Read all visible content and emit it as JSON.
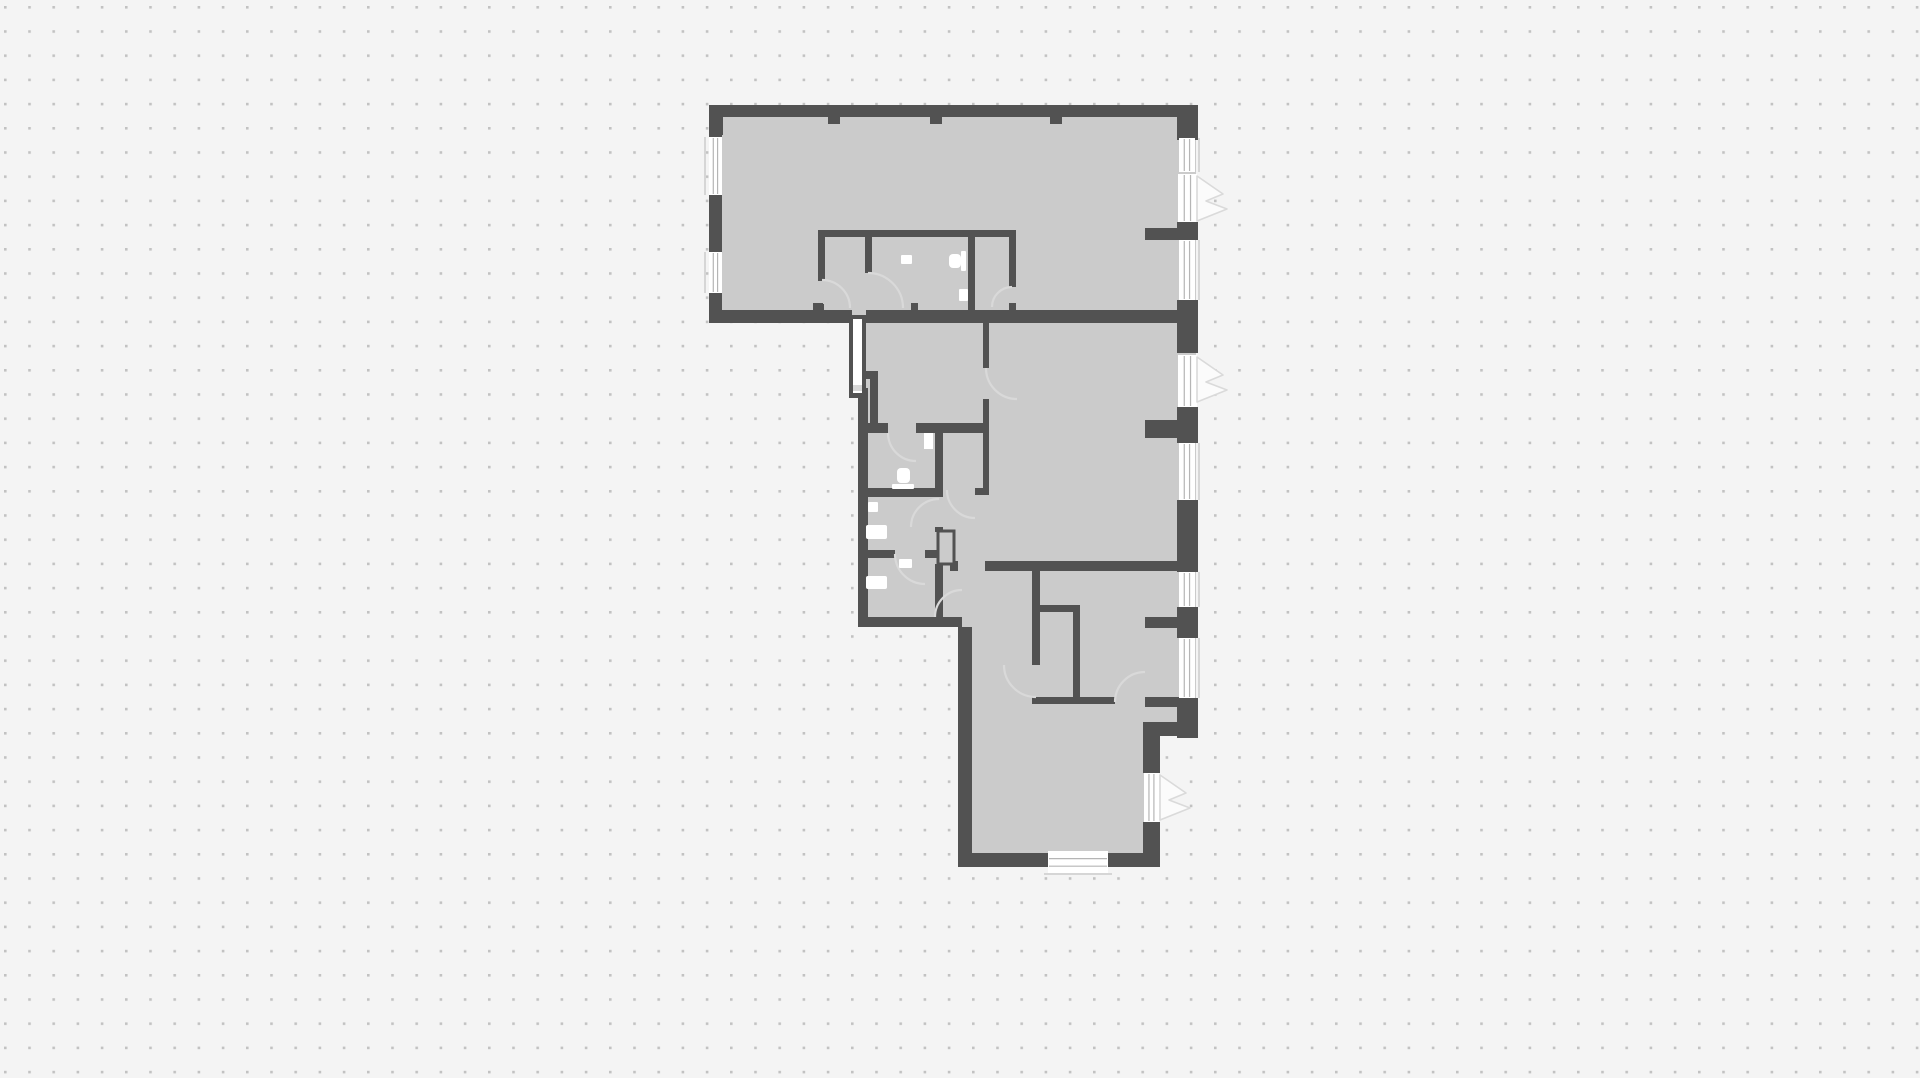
{
  "meta": {
    "width": 1920,
    "height": 1078,
    "dot_spacing": 24.2,
    "dot_size": 2.6,
    "dot_offset_x": 4,
    "dot_offset_y": 6
  },
  "styles": {
    "background": "#f4f4f4",
    "dot": "#c2c2c2",
    "floor": "#cbcbcb",
    "wall": "#525252",
    "opening": "#ffffff",
    "swing_line": "#d9d9d9",
    "wedge_fill": "#fbfbfb",
    "wedge_line": "#dadada",
    "window_line": "#b5b5b5",
    "sill": "#d6d6d6",
    "notch": "#d8d8d8",
    "fixture": "#ffffff"
  },
  "plan": {
    "floor_path": "M 710,106 L 1196,106 L 1196,734 L 1158,734 L 1158,866 L 958,866 L 958,626 L 861,626 L 861,398 L 850,398 L 850,316 L 710,316 Z",
    "walls": [
      {
        "name": "top-wall",
        "x": 709,
        "y": 105,
        "w": 489,
        "h": 12
      },
      {
        "name": "top-left-corner",
        "x": 709,
        "y": 105,
        "w": 14,
        "h": 30
      },
      {
        "name": "left-wall-a",
        "x": 709,
        "y": 117,
        "w": 13,
        "h": 20
      },
      {
        "name": "left-wall-b",
        "x": 709,
        "y": 195,
        "w": 13,
        "h": 57
      },
      {
        "name": "left-wall-c",
        "x": 709,
        "y": 293,
        "w": 13,
        "h": 30
      },
      {
        "name": "top-block-bottom-wall-left",
        "x": 709,
        "y": 310,
        "w": 143,
        "h": 13
      },
      {
        "name": "top-block-bottom-wall-right",
        "x": 866,
        "y": 310,
        "w": 332,
        "h": 13
      },
      {
        "name": "right-pier-1",
        "x": 1177,
        "y": 105,
        "w": 21,
        "h": 35
      },
      {
        "name": "right-pier-2",
        "x": 1177,
        "y": 222,
        "w": 21,
        "h": 18
      },
      {
        "name": "right-pier-3",
        "x": 1177,
        "y": 300,
        "w": 21,
        "h": 53
      },
      {
        "name": "right-pier-4",
        "x": 1177,
        "y": 407,
        "w": 21,
        "h": 36
      },
      {
        "name": "right-pier-5",
        "x": 1177,
        "y": 500,
        "w": 21,
        "h": 72
      },
      {
        "name": "right-pier-6",
        "x": 1177,
        "y": 607,
        "w": 21,
        "h": 31
      },
      {
        "name": "right-pier-7",
        "x": 1177,
        "y": 698,
        "w": 21,
        "h": 40
      },
      {
        "name": "left-wall-middle",
        "x": 858,
        "y": 388,
        "w": 10,
        "h": 239
      },
      {
        "name": "wing-bottom-wall",
        "x": 858,
        "y": 617,
        "w": 104,
        "h": 10
      },
      {
        "name": "bottom-room-left-wall",
        "x": 958,
        "y": 627,
        "w": 14,
        "h": 240
      },
      {
        "name": "bottom-wall-left",
        "x": 958,
        "y": 853,
        "w": 90,
        "h": 14
      },
      {
        "name": "bottom-wall-right",
        "x": 1108,
        "y": 853,
        "w": 52,
        "h": 14
      },
      {
        "name": "step-wall-h",
        "x": 1143,
        "y": 722,
        "w": 55,
        "h": 14
      },
      {
        "name": "lower-right-wall-a",
        "x": 1143,
        "y": 736,
        "w": 17,
        "h": 37
      },
      {
        "name": "lower-right-wall-b",
        "x": 1143,
        "y": 822,
        "w": 17,
        "h": 45
      },
      {
        "name": "stub-top-room",
        "x": 1145,
        "y": 228,
        "w": 32,
        "h": 12
      },
      {
        "name": "stub-middle-room",
        "x": 1145,
        "y": 420,
        "w": 32,
        "h": 18
      },
      {
        "name": "stub-bedroom",
        "x": 1145,
        "y": 617,
        "w": 32,
        "h": 11
      },
      {
        "name": "stub-step",
        "x": 1145,
        "y": 697,
        "w": 35,
        "h": 10
      },
      {
        "name": "mid-bottom-wall",
        "x": 985,
        "y": 561,
        "w": 213,
        "h": 10
      },
      {
        "name": "mid-bottom-wall-left",
        "x": 950,
        "y": 561,
        "w": 8,
        "h": 10
      },
      {
        "name": "partition-h1",
        "x": 818,
        "y": 230,
        "w": 198,
        "h": 7
      },
      {
        "name": "partition-va",
        "x": 818,
        "y": 237,
        "w": 7,
        "h": 44
      },
      {
        "name": "partition-va-foot",
        "x": 817,
        "y": 304,
        "w": 7,
        "h": 7
      },
      {
        "name": "partition-vb",
        "x": 865,
        "y": 237,
        "w": 7,
        "h": 36
      },
      {
        "name": "partition-vc",
        "x": 968,
        "y": 237,
        "w": 7,
        "h": 76
      },
      {
        "name": "partition-vd",
        "x": 1009,
        "y": 237,
        "w": 7,
        "h": 50
      },
      {
        "name": "partition-vd-foot",
        "x": 1009,
        "y": 303,
        "w": 7,
        "h": 10
      },
      {
        "name": "nook-h",
        "x": 866,
        "y": 371,
        "w": 12,
        "h": 8
      },
      {
        "name": "nook-v",
        "x": 870,
        "y": 379,
        "w": 8,
        "h": 49
      },
      {
        "name": "entry-bottom-wall-a",
        "x": 866,
        "y": 423,
        "w": 22,
        "h": 10
      },
      {
        "name": "entry-bottom-wall-b",
        "x": 916,
        "y": 423,
        "w": 67,
        "h": 10
      },
      {
        "name": "hall-wall-top",
        "x": 983,
        "y": 322,
        "w": 6,
        "h": 46
      },
      {
        "name": "hall-wall-mid",
        "x": 983,
        "y": 399,
        "w": 6,
        "h": 89
      },
      {
        "name": "hall-wall-foot",
        "x": 975,
        "y": 488,
        "w": 14,
        "h": 7
      },
      {
        "name": "corridor-wall",
        "x": 935,
        "y": 423,
        "w": 8,
        "h": 74
      },
      {
        "name": "corridor-wall-foot",
        "x": 935,
        "y": 527,
        "w": 8,
        "h": 5
      },
      {
        "name": "bath1-bottom-wall",
        "x": 866,
        "y": 488,
        "w": 71,
        "h": 9
      },
      {
        "name": "bath2-bottom-wall-a",
        "x": 866,
        "y": 550,
        "w": 29,
        "h": 8
      },
      {
        "name": "bath2-bottom-wall-b",
        "x": 925,
        "y": 550,
        "w": 13,
        "h": 8
      },
      {
        "name": "vestibule-wall",
        "x": 935,
        "y": 564,
        "w": 8,
        "h": 53
      },
      {
        "name": "bottom-block-wall-v1",
        "x": 1032,
        "y": 571,
        "w": 8,
        "h": 94
      },
      {
        "name": "closet-wall-h",
        "x": 1036,
        "y": 605,
        "w": 44,
        "h": 7
      },
      {
        "name": "closet-wall-v",
        "x": 1073,
        "y": 612,
        "w": 7,
        "h": 86
      },
      {
        "name": "bottom-room-wall-h",
        "x": 1032,
        "y": 697,
        "w": 83,
        "h": 7
      },
      {
        "name": "tick-top-1",
        "x": 828,
        "y": 117,
        "w": 12,
        "h": 7
      },
      {
        "name": "tick-top-2",
        "x": 930,
        "y": 117,
        "w": 12,
        "h": 7
      },
      {
        "name": "tick-top-3",
        "x": 1050,
        "y": 117,
        "w": 12,
        "h": 7
      },
      {
        "name": "tick-bottom-1",
        "x": 813,
        "y": 303,
        "w": 10,
        "h": 7
      },
      {
        "name": "tick-bottom-2",
        "x": 911,
        "y": 303,
        "w": 7,
        "h": 7
      },
      {
        "name": "tick-wing",
        "x": 935,
        "y": 610,
        "w": 8,
        "h": 7
      }
    ],
    "shaft": {
      "outer": {
        "name": "shaft-outer",
        "x": 849,
        "y": 315,
        "w": 17,
        "h": 83
      },
      "inner": {
        "name": "shaft-inner",
        "x": 853,
        "y": 319,
        "w": 9,
        "h": 74
      },
      "notch": {
        "name": "shaft-notch",
        "x": 853,
        "y": 385,
        "w": 9,
        "h": 6
      }
    },
    "duct": {
      "name": "duct-box",
      "x": 938,
      "y": 531,
      "w": 16,
      "h": 33
    },
    "windows": [
      {
        "name": "window-left-1",
        "x": 709,
        "y": 137,
        "w": 13,
        "h": 58,
        "axis": "v",
        "sill": "left"
      },
      {
        "name": "window-left-2",
        "x": 709,
        "y": 252,
        "w": 13,
        "h": 41,
        "axis": "v",
        "sill": "left"
      },
      {
        "name": "window-right-1",
        "x": 1179,
        "y": 138,
        "w": 16,
        "h": 34,
        "axis": "v",
        "sill": "right"
      },
      {
        "name": "window-right-2",
        "x": 1179,
        "y": 240,
        "w": 16,
        "h": 60,
        "axis": "v",
        "sill": "right"
      },
      {
        "name": "window-right-3",
        "x": 1179,
        "y": 443,
        "w": 16,
        "h": 57,
        "axis": "v",
        "sill": "right"
      },
      {
        "name": "window-right-4",
        "x": 1179,
        "y": 572,
        "w": 16,
        "h": 35,
        "axis": "v",
        "sill": "right"
      },
      {
        "name": "window-right-5",
        "x": 1179,
        "y": 638,
        "w": 16,
        "h": 60,
        "axis": "v",
        "sill": "right"
      },
      {
        "name": "window-bottom-1",
        "x": 1048,
        "y": 851,
        "w": 60,
        "h": 23,
        "axis": "h",
        "sill": "bottom"
      },
      {
        "name": "balcony-door-opening-top",
        "x": 1178,
        "y": 174,
        "w": 19,
        "h": 48,
        "axis": "v"
      },
      {
        "name": "balcony-door-opening-middle",
        "x": 1178,
        "y": 355,
        "w": 19,
        "h": 52,
        "axis": "v"
      },
      {
        "name": "balcony-door-opening-bottom",
        "x": 1144,
        "y": 773,
        "w": 15,
        "h": 49,
        "axis": "v"
      }
    ],
    "door_wedges": [
      {
        "name": "balcony-door-swing-top",
        "d": "M 1197,176 L 1223,194 L 1206,201 L 1227,209 L 1197,221 Z"
      },
      {
        "name": "balcony-door-swing-middle",
        "d": "M 1197,357 L 1223,375 L 1206,382 L 1227,390 L 1197,402 Z"
      },
      {
        "name": "balcony-door-swing-bottom",
        "d": "M 1160,775 L 1186,793 L 1169,800 L 1190,808 L 1160,820 Z"
      }
    ],
    "door_swings": [
      {
        "name": "door-swing-closet-a",
        "d": "M 822,280 A 28,28 0 0 1 850,308"
      },
      {
        "name": "door-swing-closet-b",
        "d": "M 868,273 A 35,35 0 0 1 903,308"
      },
      {
        "name": "door-swing-wc-top",
        "d": "M 1012,287 A 20,20 0 0 0 992,307"
      },
      {
        "name": "door-swing-bath1",
        "d": "M 888,433 A 28,28 0 0 0 916,461"
      },
      {
        "name": "door-swing-bath2",
        "d": "M 939,499 A 28,28 0 0 0 911,527"
      },
      {
        "name": "door-swing-bath3",
        "d": "M 895,554 A 30,30 0 0 0 925,584"
      },
      {
        "name": "door-swing-corridor",
        "d": "M 947,490 A 28,28 0 0 0 975,518"
      },
      {
        "name": "door-swing-middle-room",
        "d": "M 986,368 A 31,31 0 0 0 1017,399"
      },
      {
        "name": "door-swing-vestibule",
        "d": "M 962,590 A 27,27 0 0 0 935,617"
      },
      {
        "name": "door-swing-closet-2",
        "d": "M 1036,697 A 32,32 0 0 1 1004,665"
      },
      {
        "name": "door-swing-bedroom",
        "d": "M 1115,702 A 30,30 0 0 1 1145,672"
      }
    ],
    "fixtures": [
      {
        "name": "toilet-top-wc-bowl",
        "x": 949,
        "y": 254,
        "w": 12,
        "h": 14,
        "rx": 4
      },
      {
        "name": "toilet-top-wc-tank",
        "x": 961,
        "y": 251,
        "w": 5,
        "h": 20,
        "rx": 1
      },
      {
        "name": "sink-top-wc-a",
        "x": 901,
        "y": 255,
        "w": 11,
        "h": 9,
        "rx": 1
      },
      {
        "name": "sink-top-wc-b",
        "x": 959,
        "y": 289,
        "w": 9,
        "h": 12,
        "rx": 1
      },
      {
        "name": "toilet-bath1-bowl",
        "x": 897,
        "y": 468,
        "w": 13,
        "h": 15,
        "rx": 4
      },
      {
        "name": "toilet-bath1-base",
        "x": 892,
        "y": 484,
        "w": 22,
        "h": 5,
        "rx": 1
      },
      {
        "name": "door-leaf-bath1",
        "x": 924,
        "y": 433,
        "w": 9,
        "h": 16,
        "rx": 0
      },
      {
        "name": "shelf-bath2",
        "x": 868,
        "y": 502,
        "w": 10,
        "h": 10,
        "rx": 1
      },
      {
        "name": "sink-bath2",
        "x": 866,
        "y": 525,
        "w": 21,
        "h": 14,
        "rx": 2
      },
      {
        "name": "shelf-bath3",
        "x": 899,
        "y": 559,
        "w": 13,
        "h": 9,
        "rx": 1
      },
      {
        "name": "sink-bath3",
        "x": 866,
        "y": 576,
        "w": 21,
        "h": 13,
        "rx": 2
      }
    ]
  }
}
